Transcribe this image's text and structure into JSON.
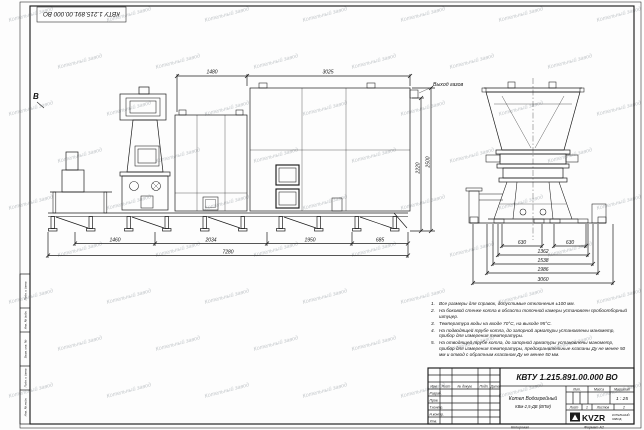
{
  "sheet": {
    "stamp": "КВТУ 1.215.891.00.000 ВО",
    "watermark": "Котельный завод",
    "copied_label": "Копировал",
    "format_label": "Формат А2"
  },
  "drawing": {
    "gas_outlet_label": "Выход газов",
    "view_label": "В",
    "dims": {
      "top": [
        "1480",
        "3025"
      ],
      "right": [
        "2220",
        "2500"
      ],
      "bottom": [
        "1460",
        "2034",
        "1950",
        "685"
      ],
      "total": "7280",
      "side": [
        "630",
        "630",
        "1362",
        "1538",
        "1986",
        "3060"
      ]
    }
  },
  "notes": [
    {
      "num": "1.",
      "text": "Все размеры для справок, допустимые отклонения ±100 мм."
    },
    {
      "num": "2.",
      "text": "На боковой стенке котла в области топочной камеры установлен пробоотборный штуцер."
    },
    {
      "num": "3.",
      "text": "Температура воды на входе 70°С, на выходе 95°С."
    },
    {
      "num": "4.",
      "text": "На подводящей трубе котла, до запорной арматуры установлены манометр, прибор для измерения температуры."
    },
    {
      "num": "5.",
      "text": "На отводящей трубе котла, до запорной арматуры установлены манометр, прибор для измерения температуры, предохранительные клапаны Ду не менее 50 мм и отвод с обратным клапаном Ду не менее 50 мм."
    }
  ],
  "title_block": {
    "doc_number": "КВТУ 1.215.891.00.000 ВО",
    "header": {
      "izm": "Изм.",
      "list": "Лист",
      "doc": "№ докум.",
      "podp": "Подп.",
      "data": "Дата"
    },
    "rows": {
      "razrab": "Разраб.",
      "prov": "Пров.",
      "tkontr": "Т.контр.",
      "nkontr": "Н.контр.",
      "utv": "Утв."
    },
    "name_line1": "Котел Водогрейный",
    "name_line2": "КВм-2,5-ДВ (ВПМ)",
    "lit_label": "Лит.",
    "mass_label": "Масса",
    "scale_label": "Масштаб",
    "scale_value": "1 : 25",
    "sheet_label": "Лист",
    "sheet_value": "1",
    "sheets_label": "Листов",
    "sheets_value": "2",
    "logo_text": "KVZR",
    "logo_sub1": "КОТЕЛЬНЫЙ",
    "logo_sub2": "ЗАВОД"
  },
  "frame": {
    "left_labels": [
      "Инв. № подл.",
      "Подп. и дата",
      "Взам. инв. №",
      "Инв. № дубл.",
      "Подп. и дата"
    ]
  }
}
